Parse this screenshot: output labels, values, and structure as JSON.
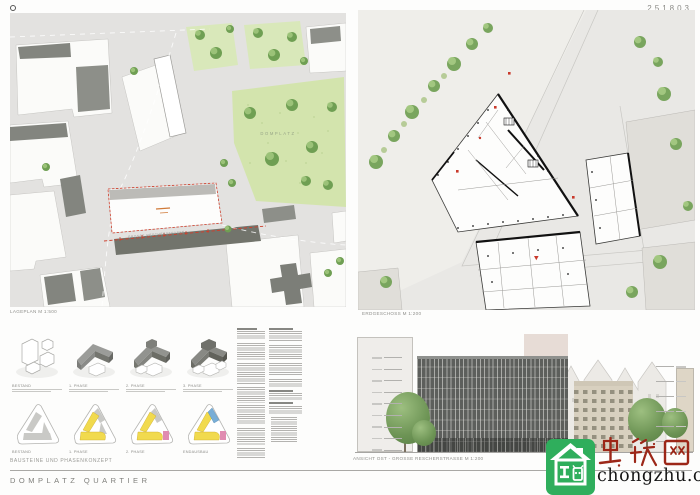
{
  "page": {
    "code": "251803",
    "project_title": "DOMPLATZ QUARTIER"
  },
  "panels": {
    "siteplan": {
      "caption": "LAGEPLAN M 1:500",
      "park_label": "DOMPLATZ",
      "street_label": "GROSSE RESCHERSTRASSE"
    },
    "floorplan": {
      "caption": "ERDGESCHOSS M 1:200"
    },
    "phasing": {
      "section_label": "BAUSTEINE UND PHASENKONZEPT",
      "axon_labels": [
        "BESTAND",
        "1. PHASE",
        "2. PHASE",
        "3. PHASE"
      ],
      "plan_labels": [
        "BESTAND",
        "1. PHASE",
        "2. PHASE",
        "ENDAUSBAU"
      ],
      "colors": {
        "yellow": "#f1da4e",
        "pink": "#e08cb1",
        "blue": "#79aed6",
        "grey": "#c9c9c6"
      }
    },
    "elevation": {
      "caption": "ANSICHT OST - GROSSE RESCHERSTRASSE M 1:200",
      "level_marks_left": 9,
      "level_marks_right": 6
    },
    "text_columns": {
      "col1": [
        {
          "heading": true,
          "lines": 4
        },
        {
          "lines": 8
        },
        {
          "lines": 10
        },
        {
          "lines": 7
        },
        {
          "lines": 9
        },
        {
          "lines": 8
        },
        {
          "lines": 5
        }
      ],
      "col2": [
        {
          "heading": true,
          "lines": 5
        },
        {
          "lines": 7
        },
        {
          "lines": 6
        },
        {
          "lines": 4
        },
        {
          "heading": true,
          "lines": 3
        },
        {
          "heading": true,
          "lines": 4
        },
        {
          "list": true,
          "lines": 12
        }
      ]
    }
  },
  "watermark": {
    "brand_cjk": "虫筑网",
    "domain": "chongzhu.cn",
    "green": "#2fae5c",
    "red": "#9c2718"
  }
}
